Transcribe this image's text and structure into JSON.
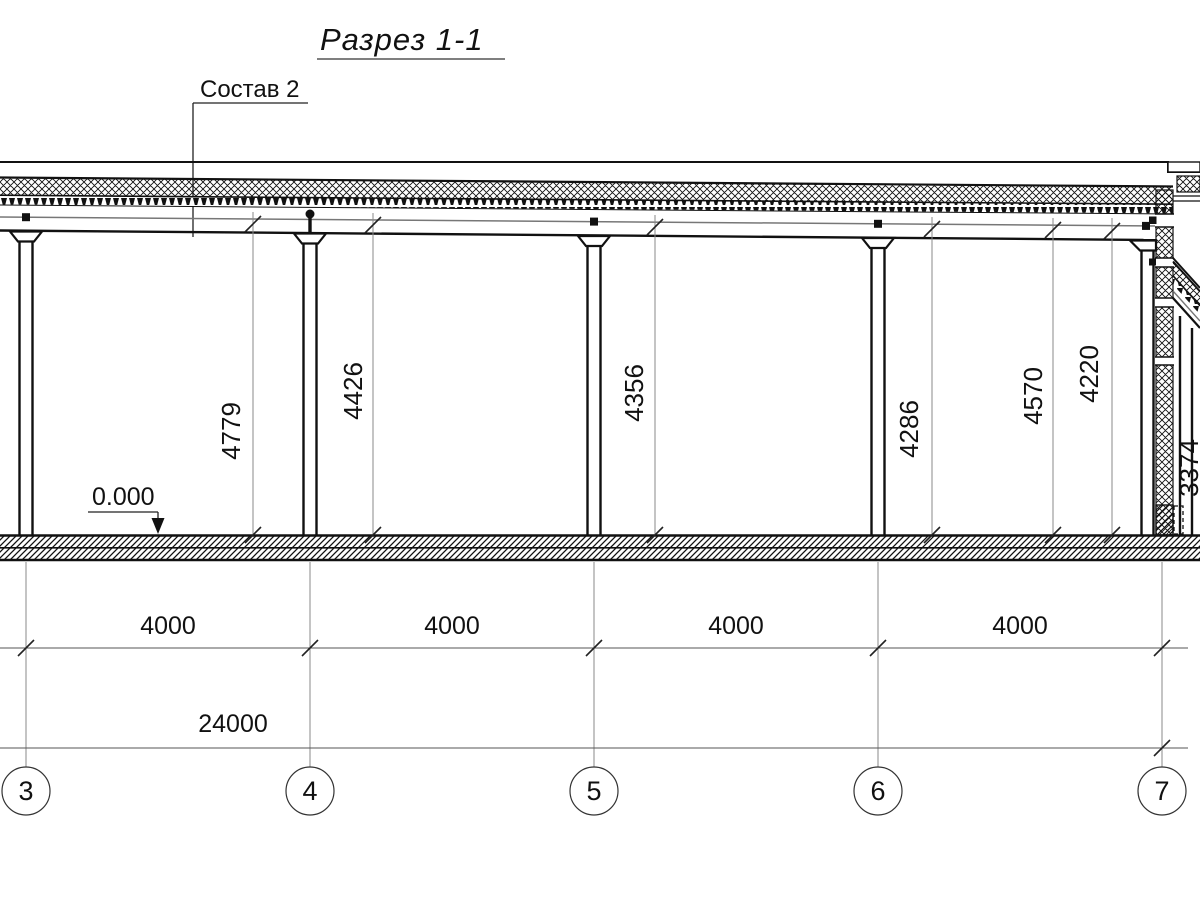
{
  "drawing": {
    "title": "Разрез 1-1",
    "callout": "Состав 2",
    "level_mark": "0.000",
    "vertical_dims": [
      "4779",
      "4426",
      "4356",
      "4286",
      "4570",
      "4220",
      "3374"
    ],
    "bay_dims": [
      "4000",
      "4000",
      "4000",
      "4000"
    ],
    "total_dim": "24000",
    "axis_labels": [
      "3",
      "4",
      "5",
      "6",
      "7"
    ]
  },
  "colors": {
    "ink": "#111111",
    "thin_line": "#8a8a8a",
    "background": "#ffffff"
  }
}
